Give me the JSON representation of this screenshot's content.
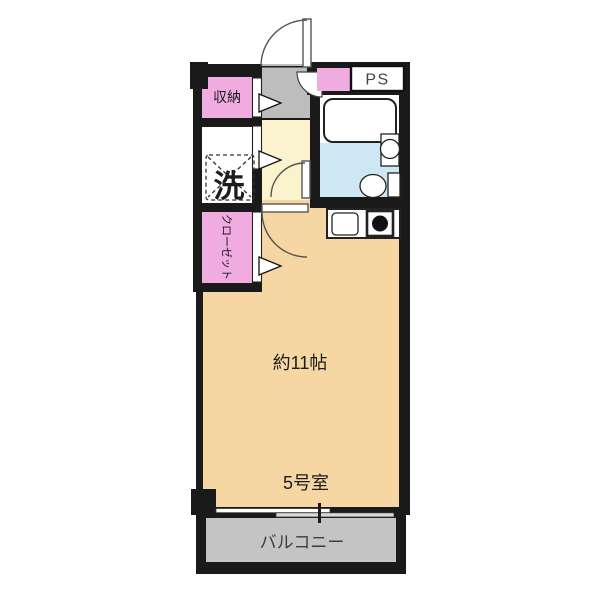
{
  "plan": {
    "title": "apartment-floor-plan",
    "labels": {
      "storage": "収納",
      "pipe_space": "PS",
      "laundry": "洗",
      "closet": "クローゼット",
      "room_size": "約11帖",
      "room_name": "5号室",
      "balcony": "バルコニー"
    },
    "colors": {
      "wall": "#1a1a1a",
      "main_room": "#F6D7A4",
      "hallway": "#FAF3CD",
      "entry": "#BDBDBD",
      "balcony": "#C4C4C4",
      "closet_pink": "#F0ABE0",
      "bath_floor": "#CDE7F4",
      "fixture_white": "#FFFFFF",
      "window_rail": "#D9D9D9"
    }
  }
}
